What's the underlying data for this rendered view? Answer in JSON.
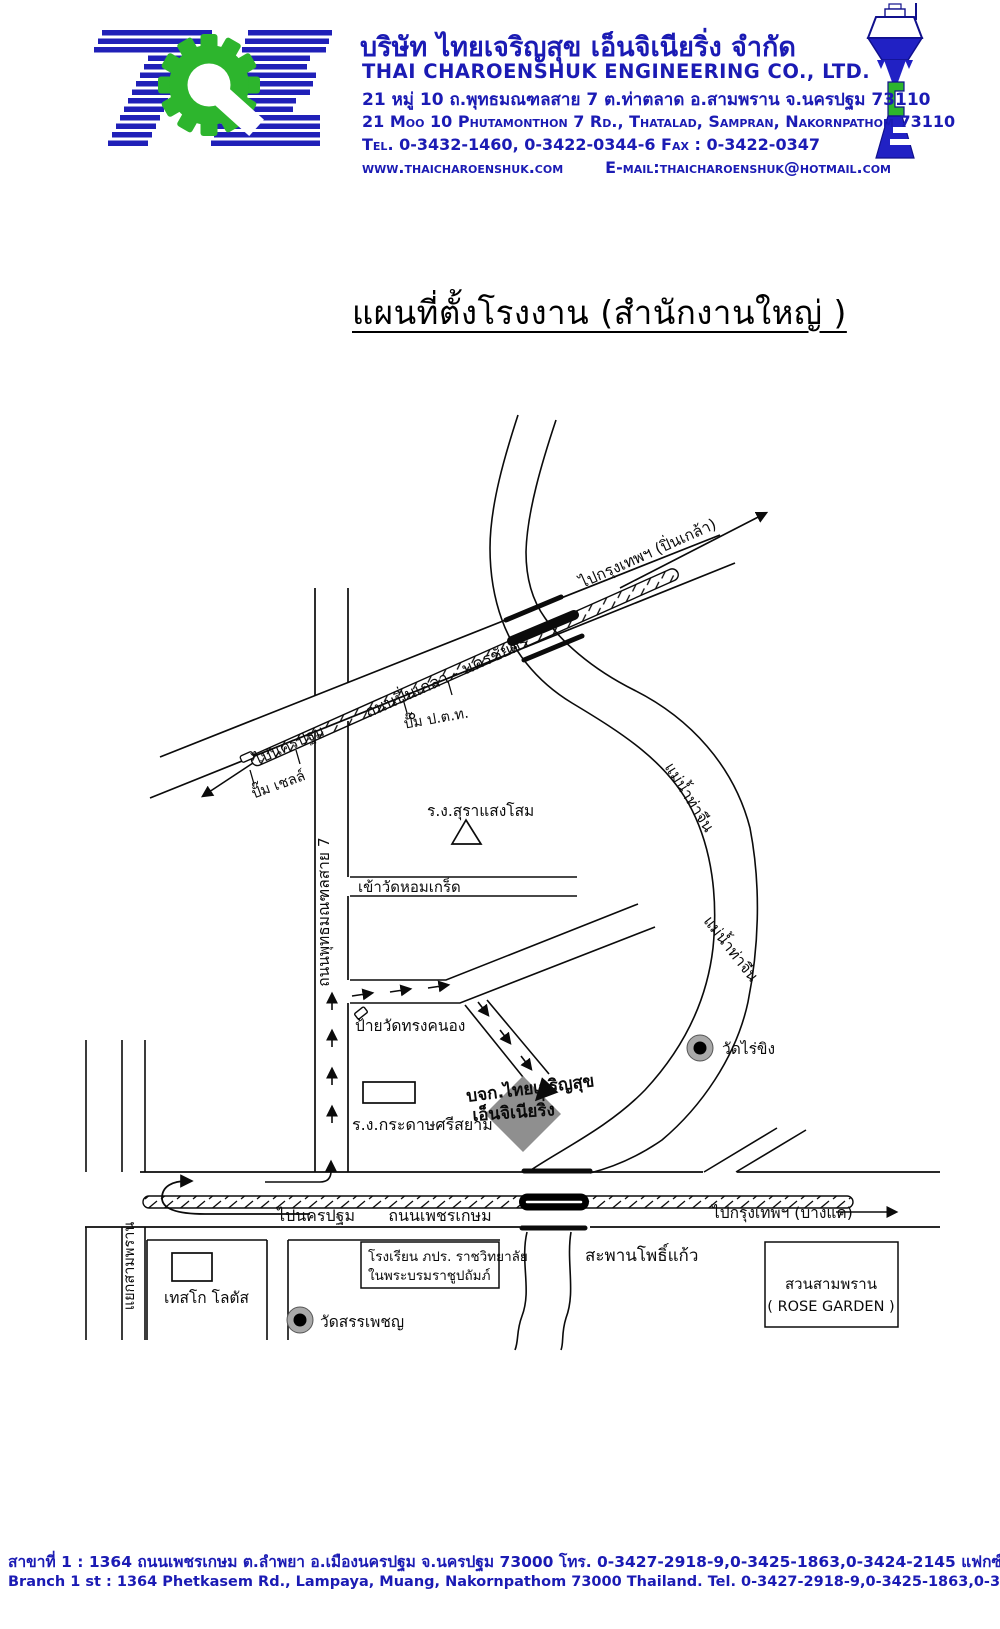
{
  "colors": {
    "brand_blue": "#2020b8",
    "brand_green": "#2db52d",
    "text_blue": "#1b1bb4",
    "map_ink": "#0b0b0b",
    "factory_gray": "#8f8f8f"
  },
  "icons": {
    "logo_gear": "gear-icon (green gear forming letter C between striped T and E)",
    "water_tower": "water-tower-icon (blue water tower forming letters T C E)",
    "temple_marker": "filled circle with gray ring",
    "factory_marker": "gray rotated square",
    "landmark_triangle": "white triangle outline"
  },
  "header": {
    "company_name_th": "บริษัท ไทยเจริญสุข  เอ็นจิเนียริ่ง  จำกัด",
    "company_name_en": "THAI  CHAROENSHUK  ENGINEERING  CO.,  LTD.",
    "address_th": "21 หมู่ 10 ถ.พุทธมณฑลสาย 7 ต.ท่าตลาด อ.สามพราน จ.นครปฐม 73110",
    "address_en": "21 Moo 10 Phutamonthon 7 Rd., Thatalad, Sampran, Nakornpathom 73110",
    "tel_fax": "Tel. 0-3432-1460, 0-3422-0344-6   Fax : 0-3422-0347",
    "website": "www.thaicharoenshuk.com",
    "email": "E-mail:thaicharoenshuk@hotmail.com"
  },
  "title": "แผนที่ตั้งโรงงาน (สำนักงานใหญ่ )",
  "map": {
    "labels": {
      "to_bangkok_pinklao": "ไปกรุงเทพฯ (ปิ่นเกล้า)",
      "road_pinklao_nakhonchaisi": "ถนนปิ่นเกลา - นครชัยศรี",
      "to_nakhonpathom_upper": "ไปนครปฐม",
      "shell_station": "ปั๊ม เชลล์",
      "ptt_station": "ปั๊ม ป.ต.ท.",
      "sangsom_distillery": "ร.ง.สุราแสงโสม",
      "road_phutthamonthon7": "ถนนพุทธมณฑลสาย 7",
      "wat_homkret_entrance": "เข้าวัดหอมเกร็ด",
      "river_thachin_upper": "แม่น้ำท่าจีน",
      "river_thachin_lower": "แม่น้ำท่าจีน",
      "wat_songkhanong_sign": "ป้ายวัดทรงคนอง",
      "srisiam_paper_factory": "ร.ง.กระดาษศรีสยาม",
      "company_location_line1": "บจก.ไทยเจริญสุข",
      "company_location_line2": "เอ็นจิเนียริ่ง",
      "wat_raikhing": "วัดไร่ขิง",
      "to_nakhonpathom_lower": "ไปนครปฐม",
      "road_phetkasem": "ถนนเพชรเกษม",
      "to_bangkok_bangkae": "ไปกรุงเทพฯ (บางแค)",
      "phokaew_bridge": "สะพานโพธิ์แก้ว",
      "sampran_junction": "แยกสามพราน",
      "tesco_lotus": "เทสโก โลตัส",
      "school_line1": "โรงเรียน ภปร. ราชวิทยาลัย",
      "school_line2": "ในพระบรมราชูปถัมภ์",
      "wat_sanphet": "วัดสรรเพชญ",
      "rose_garden_th": "สวนสามพราน",
      "rose_garden_en": "( ROSE GARDEN )"
    }
  },
  "footer": {
    "branch_th": "สาขาที่ 1  : 1364 ถนนเพชรเกษม ต.ลำพยา อ.เมืองนครปฐม จ.นครปฐม 73000   โทร. 0-3427-2918-9,0-3425-1863,0-3424-2145   แฟกซ์ : 0-3427-2919",
    "branch_en": "Branch 1 st : 1364 Phetkasem Rd., Lampaya, Muang, Nakornpathom 73000 Thailand.   Tel. 0-3427-2918-9,0-3425-1863,0-3424-2145      Fax : 0-3427-2919"
  }
}
